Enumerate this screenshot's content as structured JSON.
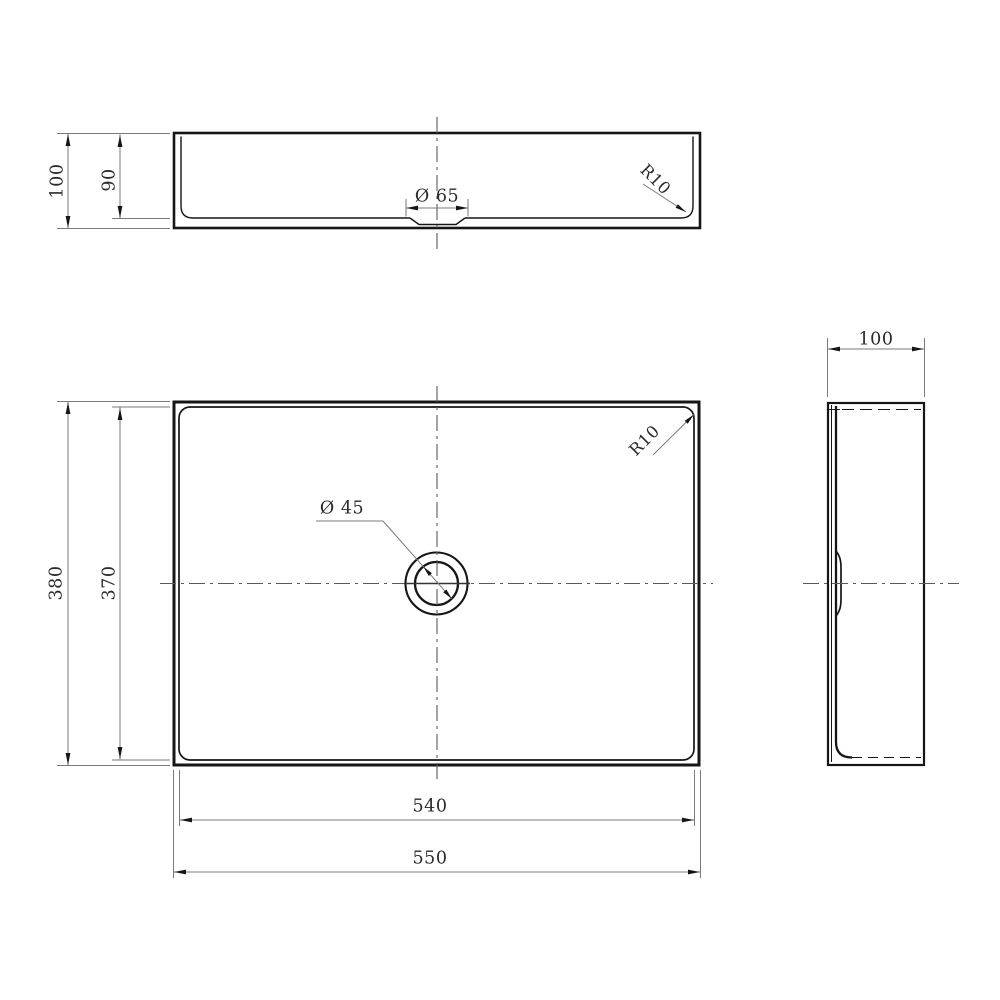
{
  "colors": {
    "object_line": "#161616",
    "dimension_line": "#707070",
    "text": "#2b2b2b"
  },
  "views": {
    "front": {
      "dims": {
        "overall_height": "100",
        "inner_depth": "90",
        "drain_recess_diameter": "Ø 65",
        "corner_radius": "R10"
      }
    },
    "plan": {
      "dims": {
        "overall_depth": "380",
        "inner_depth": "370",
        "drain_hole_diameter": "Ø 45",
        "corner_radius": "R10",
        "inner_width": "540",
        "overall_width": "550"
      }
    },
    "side": {
      "dims": {
        "overall_width": "100"
      }
    }
  }
}
